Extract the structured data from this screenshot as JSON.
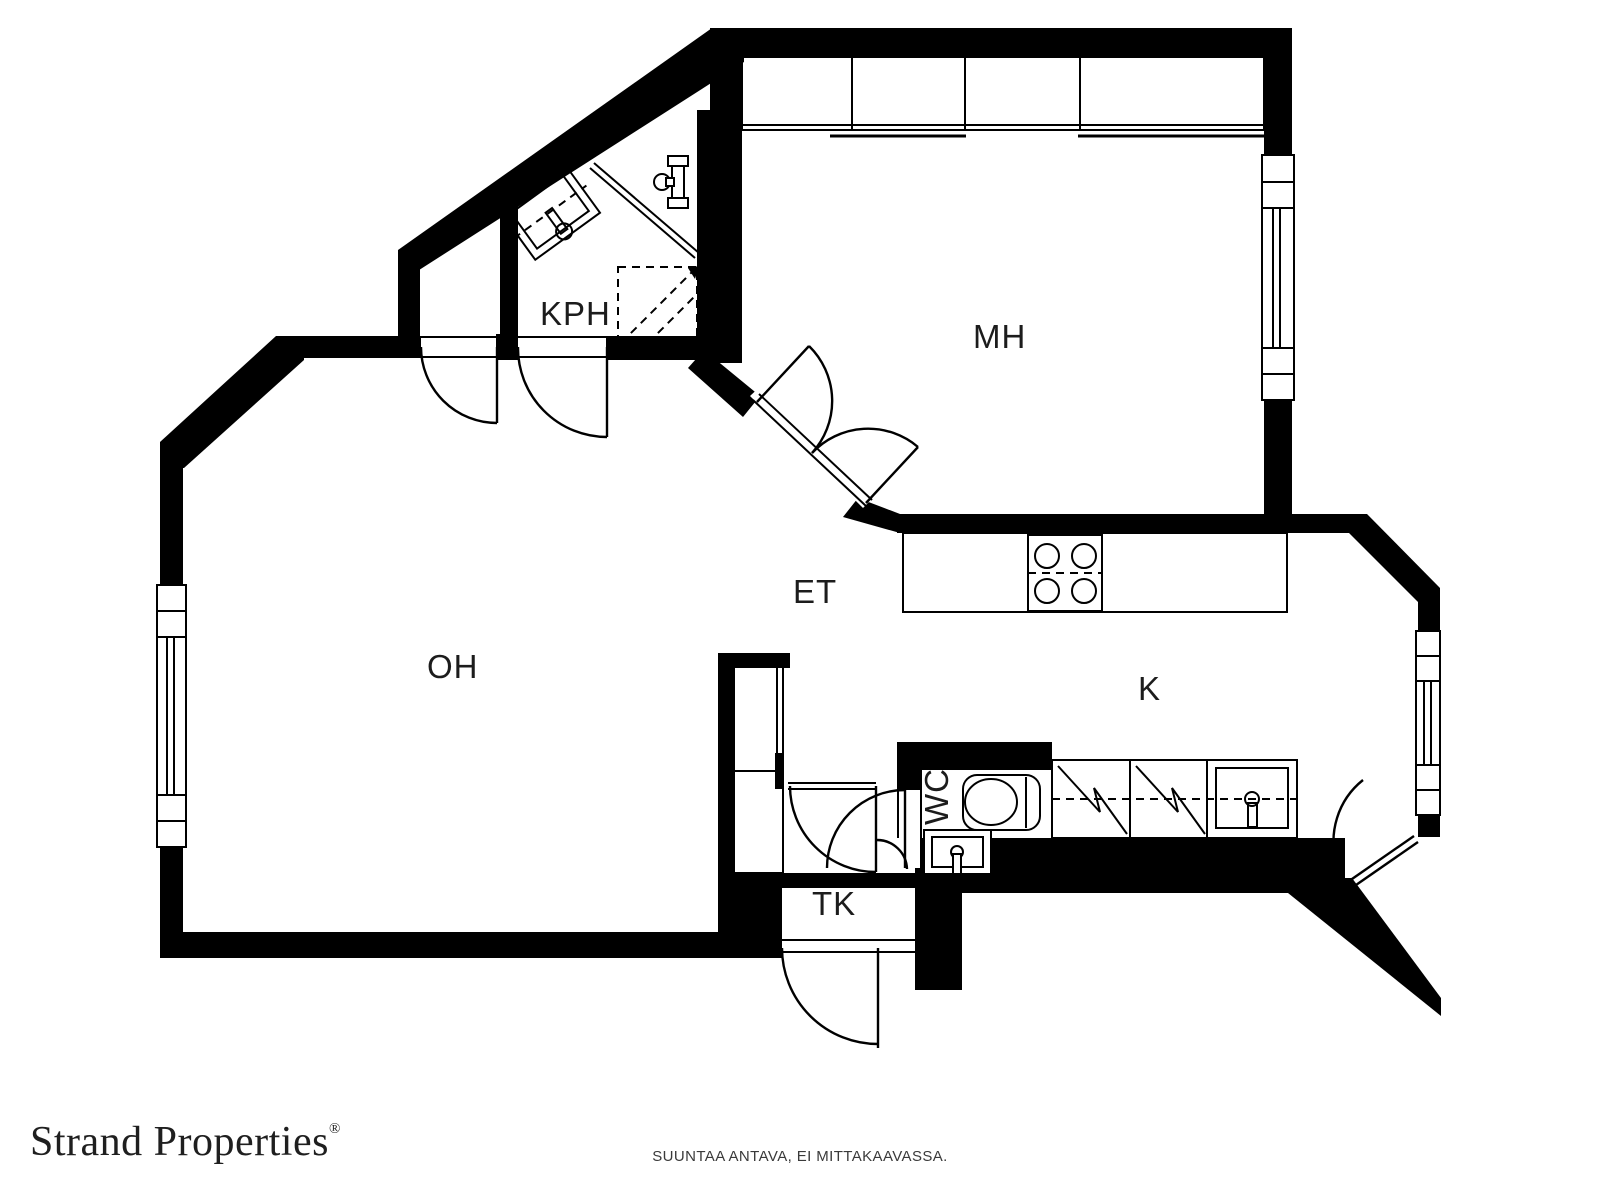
{
  "plan": {
    "wall_color": "#000000",
    "line_color": "#000000",
    "label_color": "#1c1c1c",
    "rooms": {
      "kph": "KPH",
      "mh": "MH",
      "et": "ET",
      "oh": "OH",
      "k": "K",
      "wc": "WC",
      "tk": "TK"
    }
  },
  "footer": {
    "brand": "Strand Properties",
    "brand_mark": "®",
    "disclaimer": "SUUNTAA ANTAVA, EI MITTAKAAVASSA."
  }
}
